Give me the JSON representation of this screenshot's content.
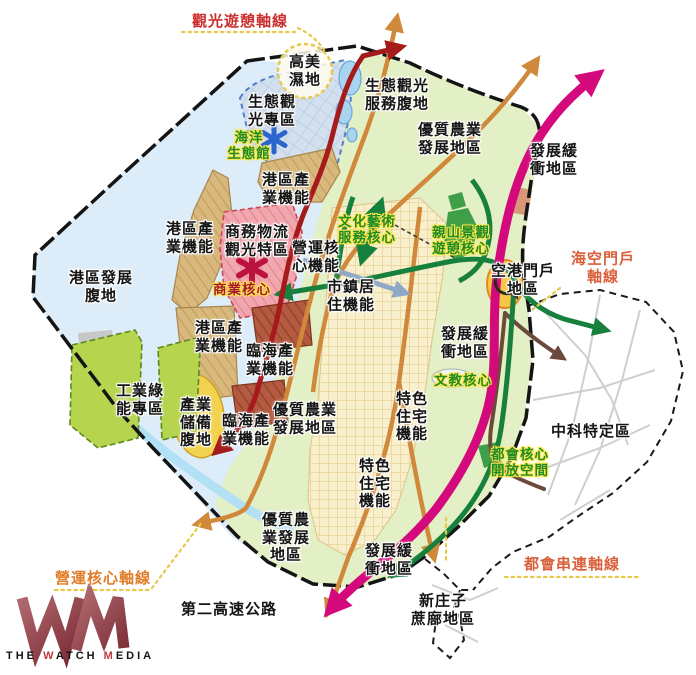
{
  "page": {
    "background": "#ffffff"
  },
  "palette": {
    "water": "#dcecf8",
    "coast": "#b2e0f4",
    "agriculture": "#e3efc4",
    "urban": "#f8efcd",
    "eco_zone": "#d3e0ef",
    "port_industry": "#d8b87c",
    "commercial": "#f2a6ae",
    "coastal_industry": "#b45a40",
    "industry_reserve": "#f2d24e",
    "green_energy": "#b6d44e",
    "airport": "#f6c646",
    "expressway": "#d40a7c",
    "tourism_axis_road": "#a51a1a",
    "orange_road": "#d0883a",
    "green_road": "#17803c",
    "brown_road": "#6b4a3c",
    "boundary": "#141414",
    "core_label": "#1f8a28",
    "core_halo": "#ffe84a"
  },
  "map": {
    "labels": [
      {
        "name": "tourism-recreation-axis",
        "text": "觀光遊憩軸線",
        "x": 240,
        "y": 22,
        "type": "axis-red"
      },
      {
        "name": "sea-air-gateway-axis",
        "text": "海空門戶\n軸線",
        "x": 603,
        "y": 268,
        "type": "axis-orange2"
      },
      {
        "name": "operations-core-axis",
        "text": "營運核心軸線",
        "x": 103,
        "y": 579,
        "type": "axis-orange"
      },
      {
        "name": "metro-link-axis",
        "text": "都會串連軸線",
        "x": 572,
        "y": 565,
        "type": "axis-orange2"
      },
      {
        "name": "gaomei-wetland",
        "text": "高美\n濕地",
        "x": 305,
        "y": 71,
        "type": "zone"
      },
      {
        "name": "eco-tourism-special-zone",
        "text": "生態觀\n光專區",
        "x": 272,
        "y": 111,
        "type": "zone"
      },
      {
        "name": "marine-eco-center",
        "text": "海洋\n生態館",
        "x": 249,
        "y": 146,
        "type": "core"
      },
      {
        "name": "eco-tourism-service-hinterland",
        "text": "生態觀光\n服務腹地",
        "x": 397,
        "y": 95,
        "type": "zone"
      },
      {
        "name": "quality-agriculture-north",
        "text": "優質農業\n發展地區",
        "x": 450,
        "y": 139,
        "type": "zone"
      },
      {
        "name": "development-buffer-northeast",
        "text": "發展緩\n衝地區",
        "x": 554,
        "y": 160,
        "type": "zone"
      },
      {
        "name": "port-industry-north",
        "text": "港區產\n業機能",
        "x": 286,
        "y": 189,
        "type": "zone"
      },
      {
        "name": "business-logistics-tourism-zone",
        "text": "商務物流\n觀光特區",
        "x": 257,
        "y": 241,
        "type": "zone"
      },
      {
        "name": "operations-core-function",
        "text": "營運核\n心機能",
        "x": 316,
        "y": 257,
        "type": "zone"
      },
      {
        "name": "commercial-core",
        "text": "商業核心",
        "x": 242,
        "y": 290,
        "type": "core-red"
      },
      {
        "name": "culture-art-service-core",
        "text": "文化藝術\n服務核心",
        "x": 367,
        "y": 230,
        "type": "core"
      },
      {
        "name": "mountain-scenic-recreation-core",
        "text": "親山景觀\n遊憩核心",
        "x": 461,
        "y": 241,
        "type": "core"
      },
      {
        "name": "town-residential-function",
        "text": "市鎮居\n住機能",
        "x": 351,
        "y": 296,
        "type": "zone"
      },
      {
        "name": "port-industry-mid",
        "text": "港區產\n業機能",
        "x": 190,
        "y": 238,
        "type": "zone"
      },
      {
        "name": "port-development-hinterland",
        "text": "港區發展\n腹地",
        "x": 101,
        "y": 287,
        "type": "zone"
      },
      {
        "name": "port-industry-south",
        "text": "港區產\n業機能",
        "x": 219,
        "y": 337,
        "type": "zone"
      },
      {
        "name": "coastal-industry-upper",
        "text": "臨海產\n業機能",
        "x": 270,
        "y": 360,
        "type": "zone"
      },
      {
        "name": "coastal-industry-lower",
        "text": "臨海產\n業機能",
        "x": 246,
        "y": 430,
        "type": "zone"
      },
      {
        "name": "industry-reserve-hinterland",
        "text": "產業\n儲備\n腹地",
        "x": 196,
        "y": 423,
        "type": "zone"
      },
      {
        "name": "industrial-green-energy-zone",
        "text": "工業綠\n能專區",
        "x": 140,
        "y": 400,
        "type": "zone"
      },
      {
        "name": "quality-agriculture-mid",
        "text": "優質農業\n發展地區",
        "x": 305,
        "y": 419,
        "type": "zone"
      },
      {
        "name": "development-buffer-east",
        "text": "發展緩\n衝地區",
        "x": 465,
        "y": 343,
        "type": "zone"
      },
      {
        "name": "culture-education-core",
        "text": "文教核心",
        "x": 463,
        "y": 381,
        "type": "core"
      },
      {
        "name": "special-residential-east",
        "text": "特色\n住宅\n機能",
        "x": 412,
        "y": 417,
        "type": "zone"
      },
      {
        "name": "special-residential-south",
        "text": "特色\n住宅\n機能",
        "x": 375,
        "y": 484,
        "type": "zone"
      },
      {
        "name": "airport-gateway-area",
        "text": "空港門戶\n地區",
        "x": 523,
        "y": 280,
        "type": "zone"
      },
      {
        "name": "metro-core-open-space",
        "text": "都會核心\n開放空間",
        "x": 520,
        "y": 463,
        "type": "core"
      },
      {
        "name": "zhongke-special-zone",
        "text": "中科特定區",
        "x": 591,
        "y": 432,
        "type": "zone"
      },
      {
        "name": "quality-agriculture-south",
        "text": "優質農\n業發展\n地區",
        "x": 286,
        "y": 538,
        "type": "zone"
      },
      {
        "name": "development-buffer-south",
        "text": "發展緩\n衝地區",
        "x": 389,
        "y": 560,
        "type": "zone"
      },
      {
        "name": "second-freeway",
        "text": "第二高速公路",
        "x": 229,
        "y": 610,
        "type": "zone"
      },
      {
        "name": "xinzhuangzi-zhebu-area",
        "text": "新庄子\n蔗廍地區",
        "x": 443,
        "y": 610,
        "type": "zone"
      }
    ]
  },
  "watermark": {
    "brand_parts": [
      {
        "text": "THE ",
        "color": "#141414"
      },
      {
        "text": "W",
        "color": "#c03a3a"
      },
      {
        "text": "ATCH ",
        "color": "#141414"
      },
      {
        "text": "M",
        "color": "#c03a3a"
      },
      {
        "text": "EDIA",
        "color": "#141414"
      }
    ]
  }
}
